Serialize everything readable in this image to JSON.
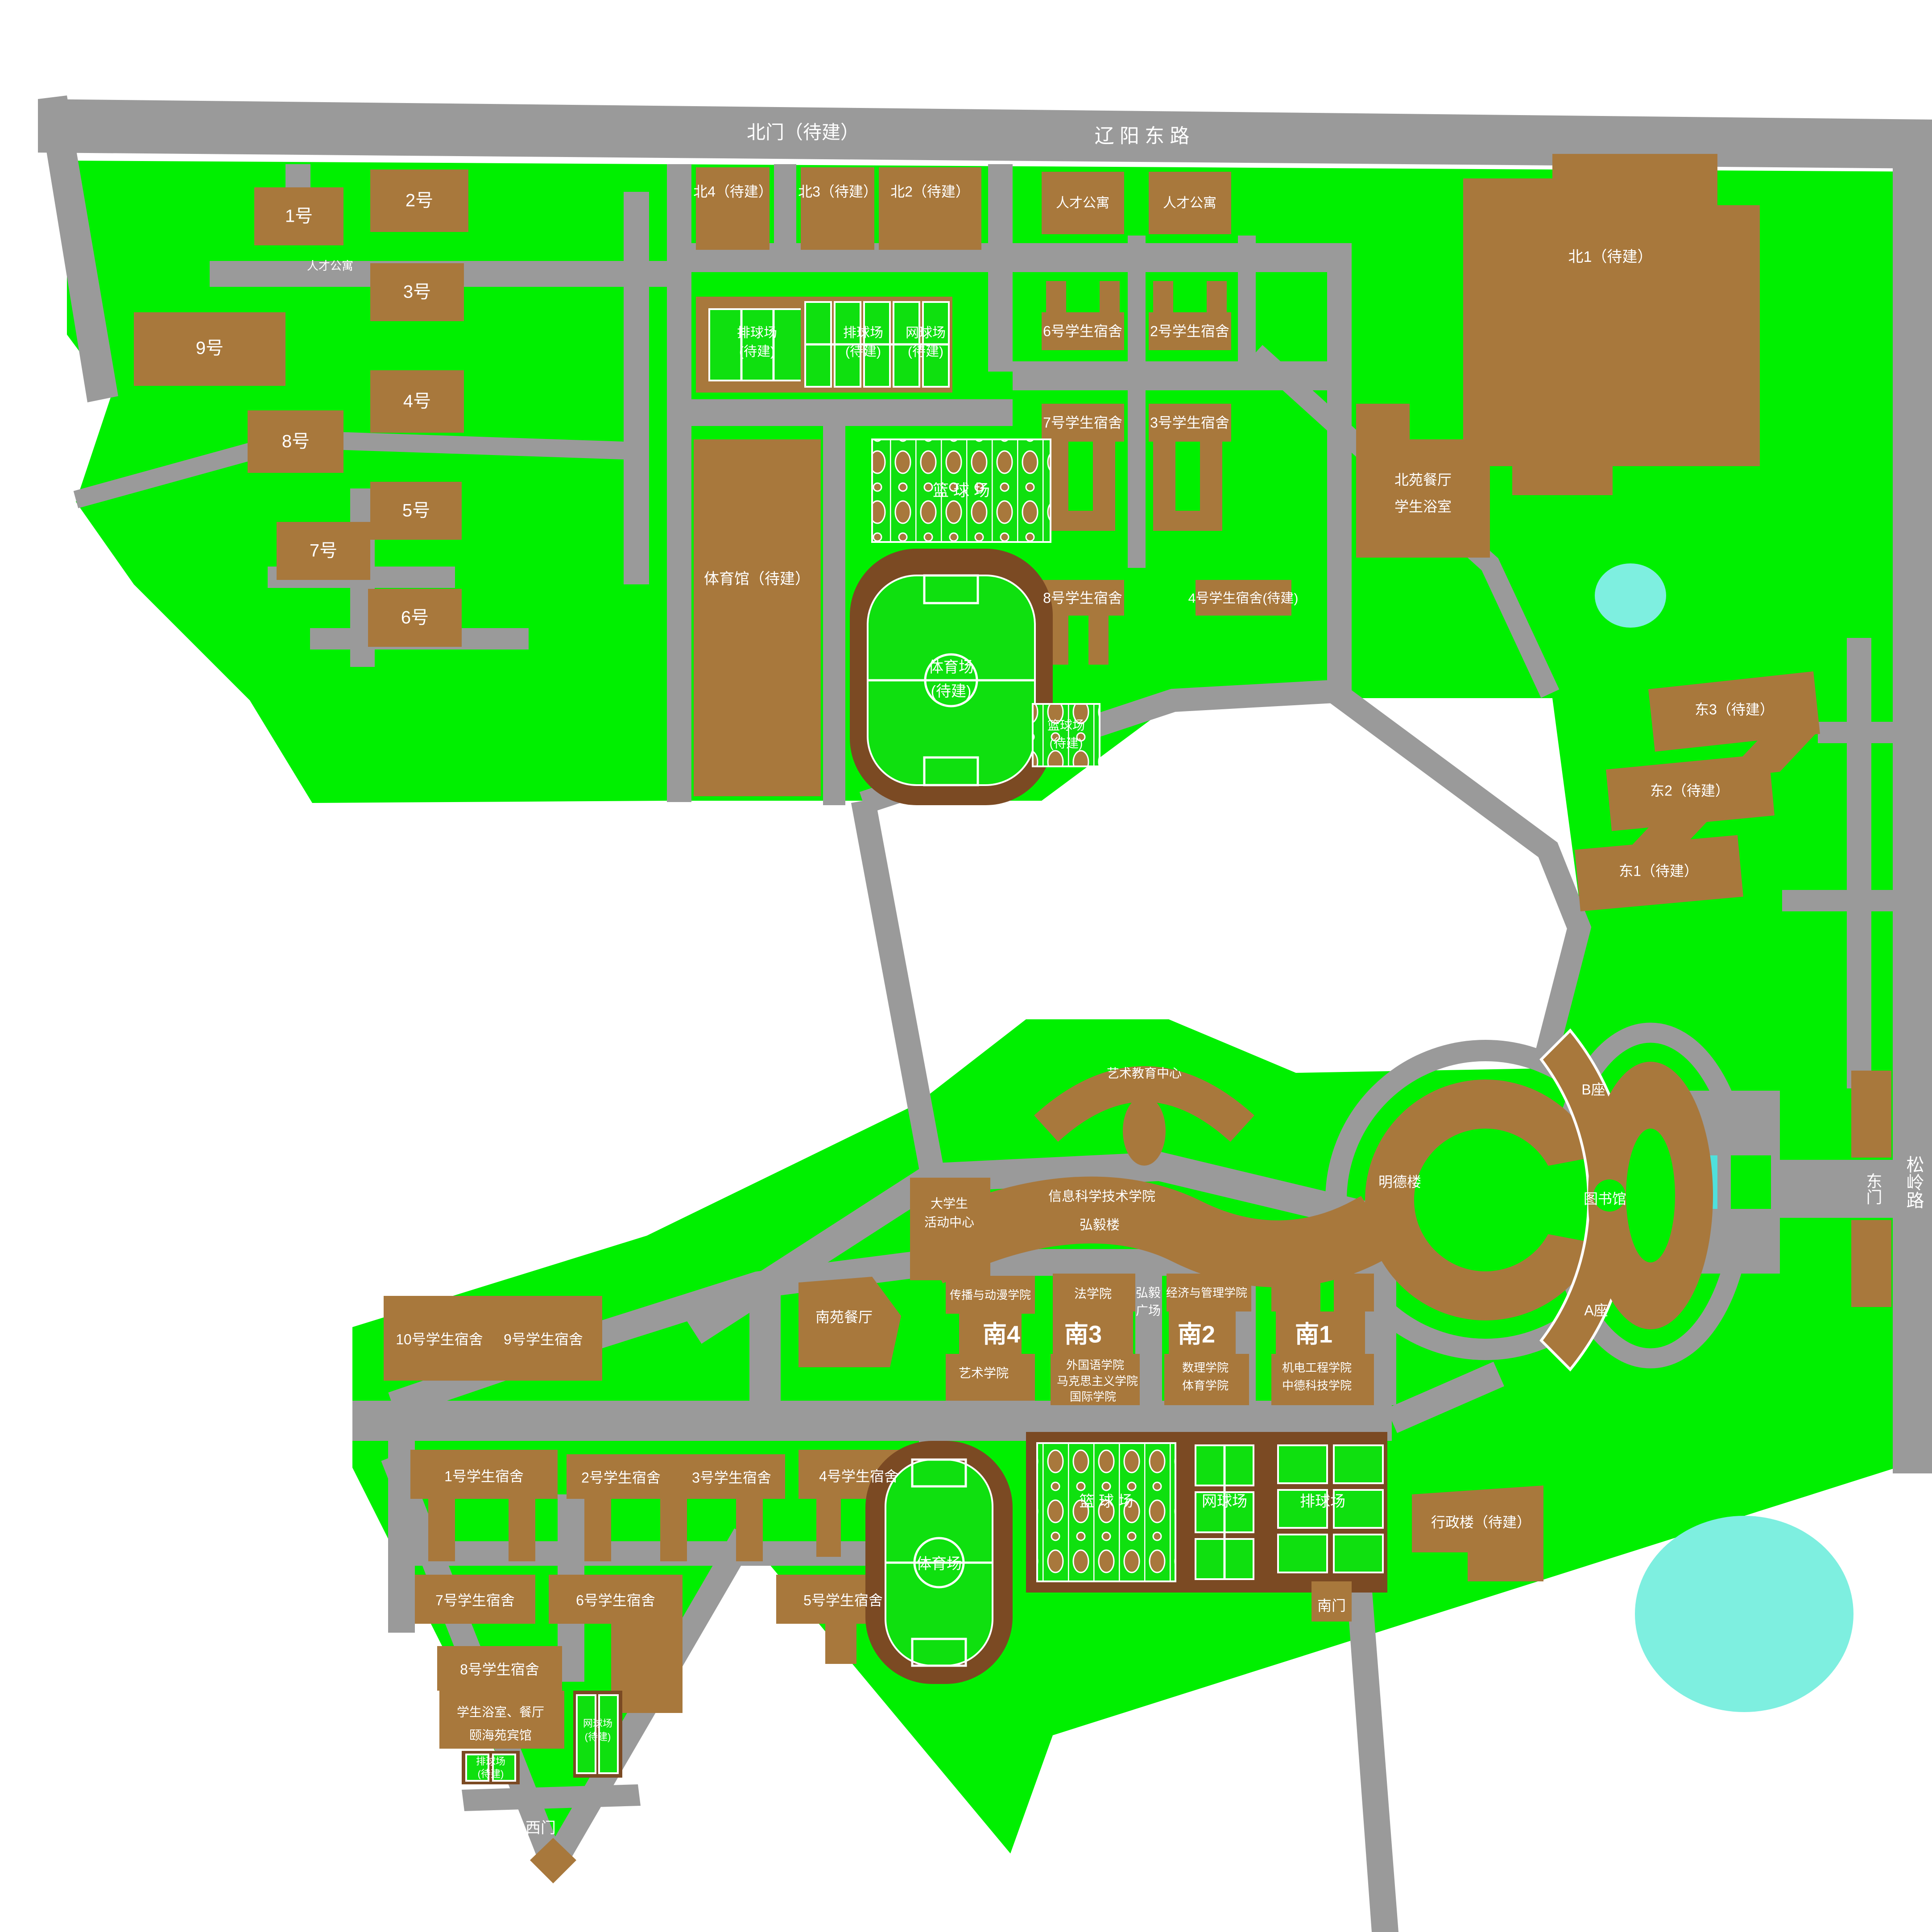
{
  "colors": {
    "grass": "#00F000",
    "court_green": "#0FE00F",
    "road_gray": "#9A9A9A",
    "building_brown": "#A8783C",
    "track_brown": "#7B4A23",
    "lake_cyan": "#7EEFE0",
    "pool_cyan": "#4FE0DC",
    "label_white": "#FFFFFF"
  },
  "roads": {
    "north_gate": "北门（待建）",
    "liaoyang_east": "辽 阳 东 路",
    "songling": "松岭路"
  },
  "gates": {
    "east": "东门",
    "south": "南门",
    "west": "西门"
  },
  "nw": {
    "rencai_area": "人才公寓",
    "b1": "1号",
    "b2": "2号",
    "b3": "3号",
    "b4": "4号",
    "b5": "5号",
    "b6": "6号",
    "b7": "7号",
    "b8": "8号",
    "b9": "9号"
  },
  "north": {
    "bei4": "北4（待建）",
    "bei3": "北3（待建）",
    "bei2": "北2（待建）",
    "bei1": "北1（待建）",
    "rencai_1": "人才公寓",
    "rencai_2": "人才公寓",
    "vb_tbd_l1": "排球场",
    "vb_tbd_l2": "(待建)",
    "vb2_tbd_l1": "排球场",
    "vb2_tbd_l2": "(待建)",
    "tennis_tbd_l1": "网球场",
    "tennis_tbd_l2": "(待建)",
    "dorm6": "6号学生宿舍",
    "dorm2": "2号学生宿舍",
    "dorm7": "7号学生宿舍",
    "dorm3": "3号学生宿舍",
    "dorm8": "8号学生宿舍",
    "dorm4": "4号学生宿舍(待建)",
    "basketball": "篮 球 场",
    "bb_tbd_l1": "篮球场",
    "bb_tbd_l2": "(待建)",
    "gym": "体育馆（待建）",
    "stadium_l1": "体育场",
    "stadium_l2": "(待建)",
    "canteen_l1": "北苑餐厅",
    "canteen_l2": "学生浴室"
  },
  "east": {
    "dong3": "东3（待建）",
    "dong2": "东2（待建）",
    "dong1": "东1（待建）"
  },
  "center": {
    "art_center": "艺术教育中心",
    "student_l1": "大学生",
    "student_l2": "活动中心",
    "info_college": "信息科学技术学院",
    "hongyi_bldg": "弘毅楼",
    "mingde": "明德楼",
    "block_b": "B座",
    "library": "图书馆",
    "block_a": "A座"
  },
  "colleges": {
    "media": "传播与动漫学院",
    "nan4": "南4",
    "art": "艺术学院",
    "law": "法学院",
    "nan3": "南3",
    "foreign": "外国语学院",
    "marx": "马克思主义学院",
    "intl": "国际学院",
    "hongyi_l1": "弘毅",
    "hongyi_l2": "广场",
    "econ": "经济与管理学院",
    "nan2": "南2",
    "math": "数理学院",
    "pe": "体育学院",
    "nan1": "南1",
    "mech": "机电工程学院",
    "sino_german": "中德科技学院"
  },
  "south": {
    "canteen": "南苑餐厅",
    "dorm10": "10号学生宿舍",
    "dorm9": "9号学生宿舍",
    "dorm1": "1号学生宿舍",
    "dorm2": "2号学生宿舍",
    "dorm3": "3号学生宿舍",
    "dorm4": "4号学生宿舍",
    "dorm7": "7号学生宿舍",
    "dorm6": "6号学生宿舍",
    "dorm5": "5号学生宿舍",
    "dorm8": "8号学生宿舍",
    "stadium": "体育场",
    "basketball": "篮 球 场",
    "tennis": "网球场",
    "volleyball": "排球场",
    "admin": "行政楼（待建）",
    "bath_l1": "学生浴室、餐厅",
    "bath_l2": "颐海苑宾馆",
    "vb_tbd_l1": "排球场",
    "vb_tbd_l2": "(待建)",
    "tn_tbd_l1": "网球场",
    "tn_tbd_l2": "(待建)"
  }
}
